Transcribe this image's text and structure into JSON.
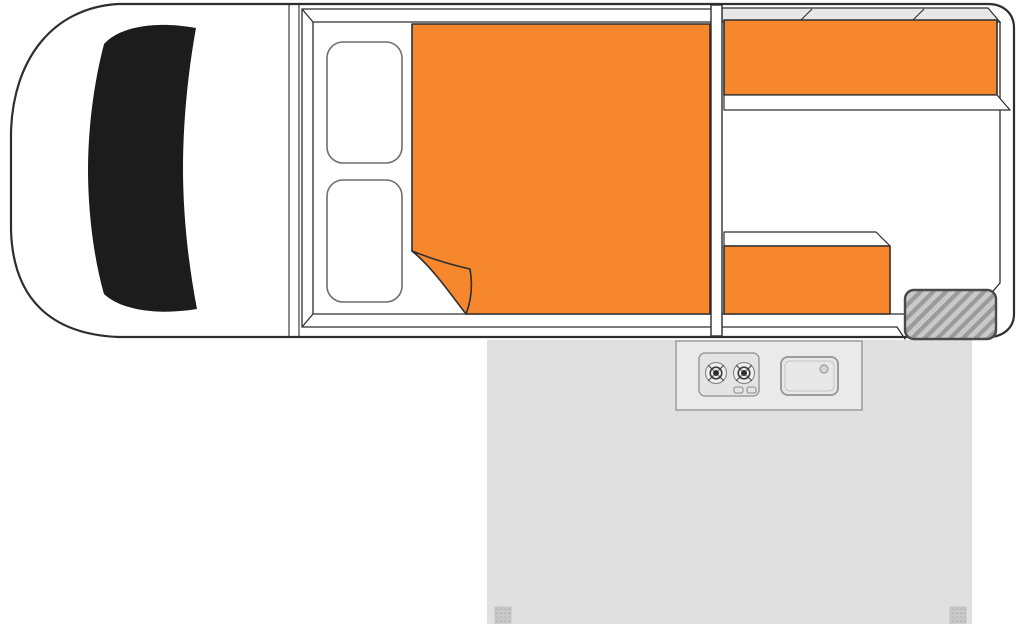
{
  "diagram": {
    "type": "floorplan",
    "subject": "campervan-interior-layout-top-view"
  },
  "colors": {
    "accent_orange": "#F6872D",
    "outline_dark": "#2E2E2E",
    "windshield_black": "#1C1C1C",
    "body_white": "#FFFFFF",
    "annex_gray": "#E0E0E0",
    "band_gray": "#E7E7E7",
    "hatch_fill": "#C9C9C9",
    "hatch_stripe": "#9B9B9B",
    "peg_fill": "#C9C9C9",
    "peg_dot": "#ACACAC",
    "fixture_fill": "#EAEAEA",
    "stove_fill": "#E4E4E4",
    "sink_fill": "#E8E8E8",
    "burner_outer": "#F1F1F1",
    "burner_center": "#2E2E2E",
    "drain_fill": "#D6D6D6"
  },
  "components": {
    "van": {
      "cab": "driver-cab",
      "windshield": "windshield",
      "bulkhead": "cab-bulkhead"
    },
    "interior": {
      "cab_seats": [
        "cab-seat-upper",
        "cab-seat-lower"
      ],
      "bed": "double-bed-mattress",
      "bed_fold": "mattress-folded-corner",
      "partition": "partition-wall",
      "bench_upper": "rear-bench-upper",
      "bench_lower": "rear-bench-lower",
      "window_band": "rear-window-band",
      "hatched_unit": "hatched-storage-unit"
    },
    "outside": {
      "annex": "awning-annex-area",
      "kitchen_unit": "slide-out-kitchen",
      "stove": "two-burner-stove",
      "stove_knobs": [
        "stove-knob-left",
        "stove-knob-right"
      ],
      "sink": "sink",
      "sink_drain": "sink-drain",
      "pegs": [
        "annex-peg-left",
        "annex-peg-right"
      ]
    }
  }
}
